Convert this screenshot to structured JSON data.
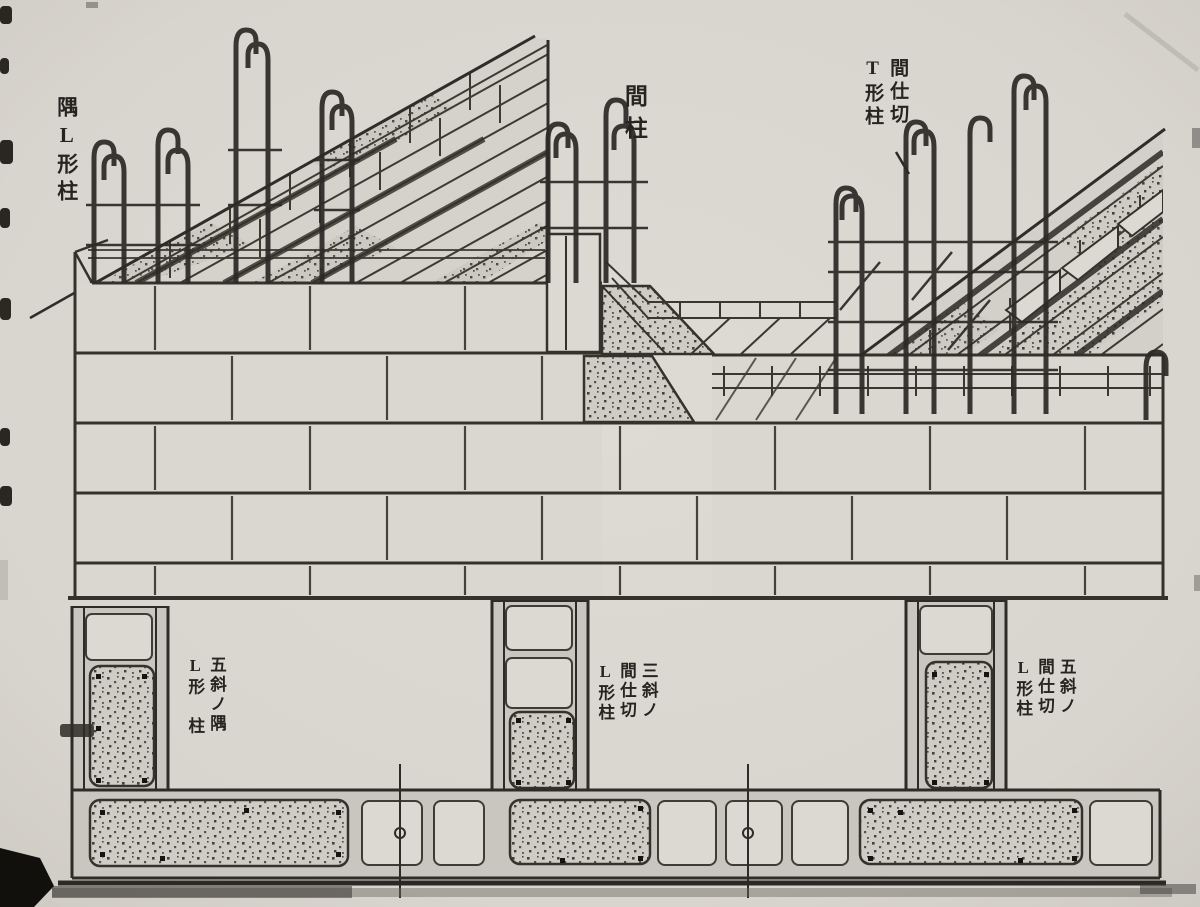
{
  "figure": {
    "kind": "scanned construction diagram",
    "subject": "reinforced concrete block wall corner and partition column reinforcement, axonometric view above and plan sections below"
  },
  "labels": {
    "corner_l_column": "隅L形柱",
    "stud_column": "間柱",
    "partition_t_column": "間仕切\nT形柱",
    "plan_corner_l_column": "五斜ノ隅\nL形　柱",
    "plan_partition_center": "三斜ノ\n間仕切\nL形柱",
    "plan_partition_right": "五斜ノ\n間仕切\nL形柱"
  },
  "colors": {
    "paper": "#d8d5ce",
    "ink": "#35322c",
    "stipple_base": "#ccc9c2",
    "block_face": "#dad7d0"
  }
}
